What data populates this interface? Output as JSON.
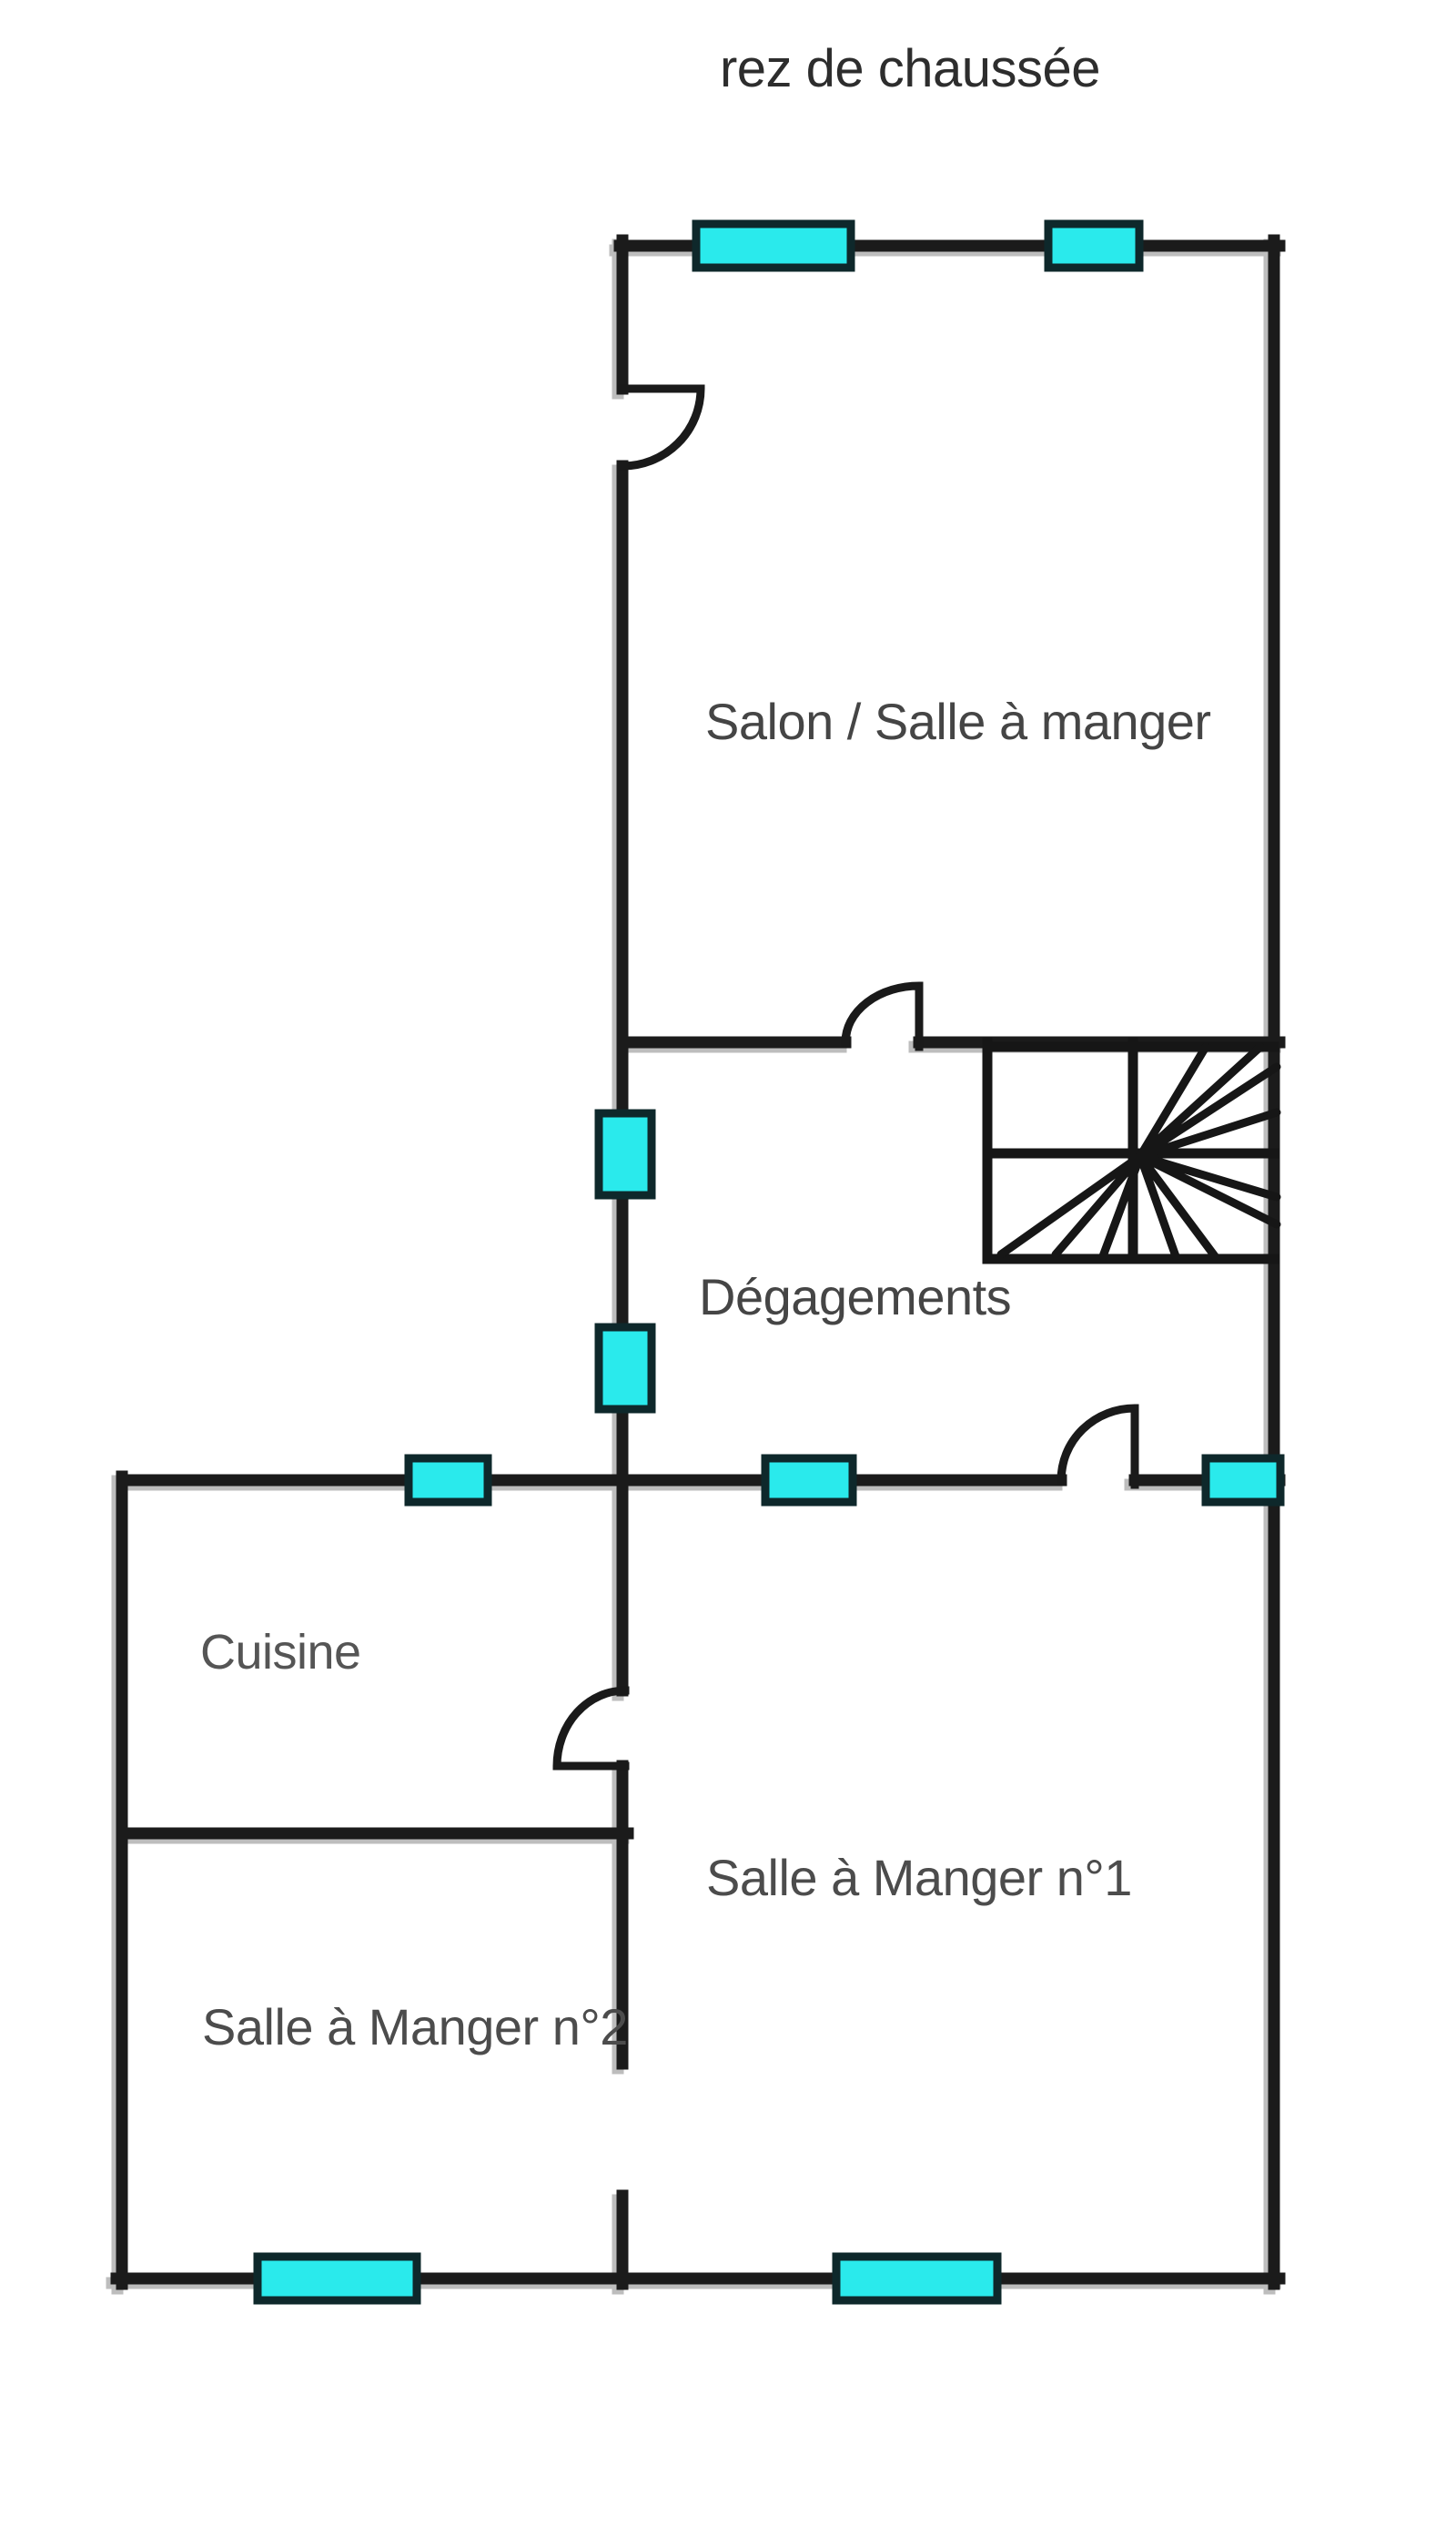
{
  "title": "rez de chaussée",
  "rooms": [
    {
      "id": "salon",
      "label": "Salon / Salle à manger"
    },
    {
      "id": "degagements",
      "label": "Dégagements"
    },
    {
      "id": "cuisine",
      "label": "Cuisine"
    },
    {
      "id": "sam1",
      "label": "Salle à Manger n°1"
    },
    {
      "id": "sam2",
      "label": "Salle à Manger n°2"
    }
  ],
  "colors": {
    "wall": "#1b1b1b",
    "wall_shadow": "#bdbdbd",
    "window_fill": "#2aeaec",
    "window_border": "#0e282b",
    "label_text": "#454545",
    "title_text": "#2d2d2d",
    "background": "#ffffff"
  },
  "features": {
    "windows_count": 9,
    "doors_count": 4,
    "staircase": "winder-stair with radiating treads, bottom-right of Dégagements"
  }
}
